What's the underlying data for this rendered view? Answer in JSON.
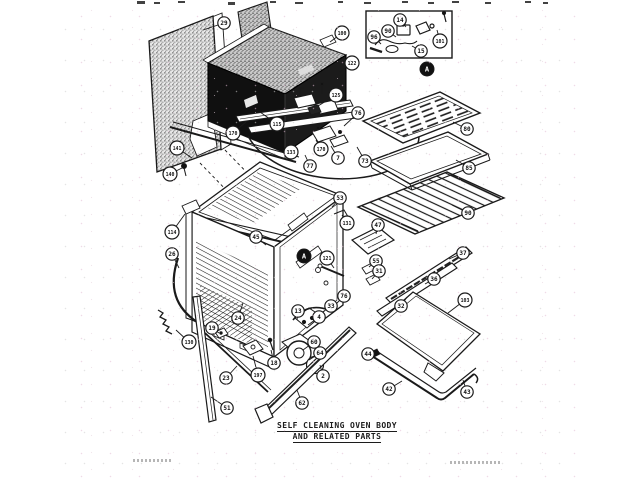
{
  "title": {
    "line1": "SELF CLEANING OVEN BODY",
    "line2": "AND RELATED PARTS"
  },
  "ink_color": "#1a1a1a",
  "detail_markers": [
    {
      "label": "A",
      "x": 427,
      "y": 69
    },
    {
      "label": "A",
      "x": 304,
      "y": 256
    }
  ],
  "callouts": [
    {
      "n": "29",
      "x": 224,
      "y": 23,
      "tx": 203,
      "ty": 30
    },
    {
      "n": "141",
      "x": 177,
      "y": 148,
      "tx": 192,
      "ty": 158
    },
    {
      "n": "100",
      "x": 342,
      "y": 33,
      "tx": 330,
      "ty": 42
    },
    {
      "n": "122",
      "x": 352,
      "y": 63,
      "tx": 340,
      "ty": 72
    },
    {
      "n": "125",
      "x": 336,
      "y": 95,
      "tx": 318,
      "ty": 106
    },
    {
      "n": "115",
      "x": 277,
      "y": 124,
      "tx": 260,
      "ty": 112
    },
    {
      "n": "170",
      "x": 233,
      "y": 133,
      "tx": 246,
      "ty": 122
    },
    {
      "n": "140",
      "x": 170,
      "y": 174,
      "tx": 182,
      "ty": 168
    },
    {
      "n": "14",
      "x": 400,
      "y": 20,
      "tx": 406,
      "ty": 27
    },
    {
      "n": "90",
      "x": 388,
      "y": 31,
      "tx": 396,
      "ty": 37
    },
    {
      "n": "96",
      "x": 374,
      "y": 37,
      "tx": 381,
      "ty": 44
    },
    {
      "n": "101",
      "x": 440,
      "y": 41,
      "tx": 437,
      "ty": 30
    },
    {
      "n": "15",
      "x": 421,
      "y": 51,
      "tx": 412,
      "ty": 46
    },
    {
      "n": "76",
      "x": 358,
      "y": 113,
      "tx": 344,
      "ty": 126
    },
    {
      "n": "170",
      "x": 321,
      "y": 149,
      "tx": 316,
      "ty": 140
    },
    {
      "n": "7",
      "x": 338,
      "y": 158,
      "tx": 331,
      "ty": 146
    },
    {
      "n": "73",
      "x": 365,
      "y": 161,
      "tx": 357,
      "ty": 147
    },
    {
      "n": "133",
      "x": 291,
      "y": 152,
      "tx": 286,
      "ty": 142
    },
    {
      "n": "77",
      "x": 310,
      "y": 166,
      "tx": 305,
      "ty": 155
    },
    {
      "n": "80",
      "x": 467,
      "y": 129,
      "tx": 453,
      "ty": 122
    },
    {
      "n": "85",
      "x": 469,
      "y": 168,
      "tx": 456,
      "ty": 160
    },
    {
      "n": "90",
      "x": 468,
      "y": 213,
      "tx": 452,
      "ty": 205
    },
    {
      "n": "114",
      "x": 172,
      "y": 232,
      "tx": 185,
      "ty": 214
    },
    {
      "n": "26",
      "x": 172,
      "y": 254,
      "tx": 179,
      "ty": 268
    },
    {
      "n": "45",
      "x": 256,
      "y": 237,
      "tx": 266,
      "ty": 245
    },
    {
      "n": "53",
      "x": 340,
      "y": 198,
      "tx": 332,
      "ty": 207
    },
    {
      "n": "131",
      "x": 347,
      "y": 223,
      "tx": 342,
      "ty": 215
    },
    {
      "n": "47",
      "x": 378,
      "y": 225,
      "tx": 376,
      "ty": 234
    },
    {
      "n": "121",
      "x": 327,
      "y": 258,
      "tx": 334,
      "ty": 268
    },
    {
      "n": "24",
      "x": 238,
      "y": 318,
      "tx": 243,
      "ty": 303
    },
    {
      "n": "55",
      "x": 376,
      "y": 261,
      "tx": 369,
      "ty": 267
    },
    {
      "n": "31",
      "x": 379,
      "y": 271,
      "tx": 372,
      "ty": 279
    },
    {
      "n": "37",
      "x": 463,
      "y": 253,
      "tx": 449,
      "ty": 259
    },
    {
      "n": "36",
      "x": 434,
      "y": 279,
      "tx": 425,
      "ty": 284
    },
    {
      "n": "32",
      "x": 401,
      "y": 306,
      "tx": 407,
      "ty": 297
    },
    {
      "n": "103",
      "x": 465,
      "y": 300,
      "tx": 448,
      "ty": 313
    },
    {
      "n": "44",
      "x": 368,
      "y": 354,
      "tx": 373,
      "ty": 356
    },
    {
      "n": "42",
      "x": 389,
      "y": 389,
      "tx": 402,
      "ty": 381
    },
    {
      "n": "43",
      "x": 467,
      "y": 392,
      "tx": 463,
      "ty": 380
    },
    {
      "n": "130",
      "x": 189,
      "y": 342,
      "tx": 176,
      "ty": 330
    },
    {
      "n": "19",
      "x": 212,
      "y": 328,
      "tx": 219,
      "ty": 333
    },
    {
      "n": "23",
      "x": 226,
      "y": 378,
      "tx": 237,
      "ty": 366
    },
    {
      "n": "197",
      "x": 258,
      "y": 375,
      "tx": 253,
      "ty": 356
    },
    {
      "n": "18",
      "x": 274,
      "y": 363,
      "tx": 271,
      "ty": 350
    },
    {
      "n": "51",
      "x": 227,
      "y": 408,
      "tx": 211,
      "ty": 397
    },
    {
      "n": "62",
      "x": 302,
      "y": 403,
      "tx": 297,
      "ty": 390
    },
    {
      "n": "2",
      "x": 323,
      "y": 376,
      "tx": 320,
      "ty": 365
    },
    {
      "n": "64",
      "x": 320,
      "y": 353,
      "tx": 309,
      "ty": 360
    },
    {
      "n": "60",
      "x": 314,
      "y": 342,
      "tx": 303,
      "ty": 350
    },
    {
      "n": "13",
      "x": 298,
      "y": 311,
      "tx": 297,
      "ty": 320
    },
    {
      "n": "4",
      "x": 319,
      "y": 317,
      "tx": 308,
      "ty": 325
    },
    {
      "n": "33",
      "x": 331,
      "y": 306,
      "tx": 320,
      "ty": 314
    },
    {
      "n": "76",
      "x": 344,
      "y": 296,
      "tx": 334,
      "ty": 306
    }
  ]
}
